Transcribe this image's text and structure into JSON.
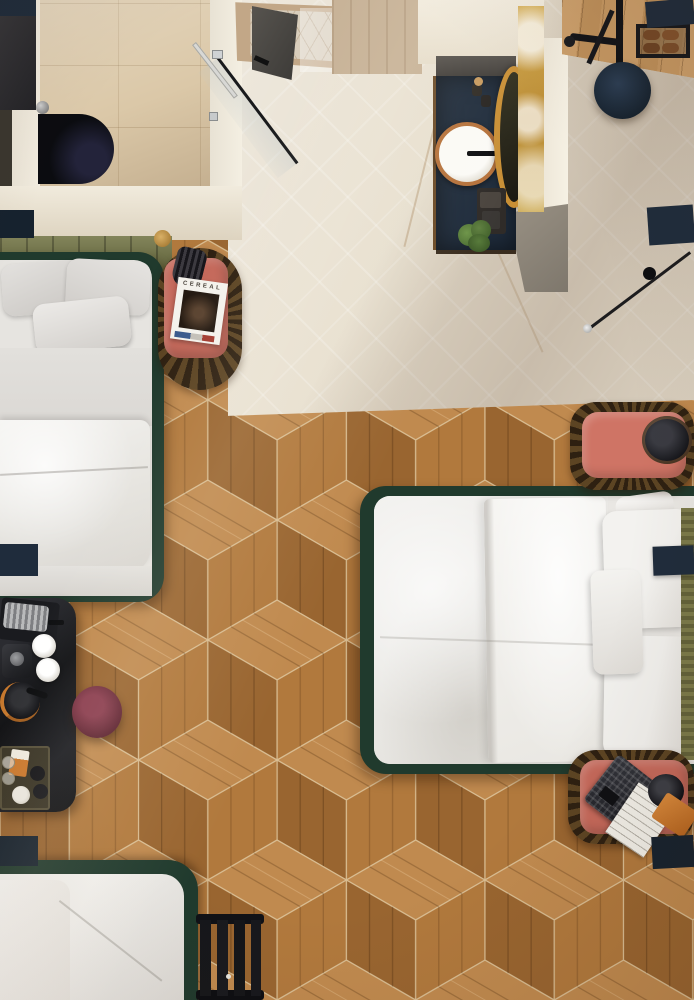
{
  "magazine": {
    "title": "CEREAL"
  },
  "palette": {
    "navy": "#1f2c3c",
    "navy_deep": "#16222e",
    "coral": "#c4685a",
    "coral_light": "#cf7465",
    "burgundy": "#5f2331",
    "olive": "#6d6f3e",
    "olive_throw": "#7b7a4a",
    "bed_frame_green": "#203a2d",
    "bed_frame_dark": "#152820",
    "wood_top": "#c08a4f",
    "wood_left": "#996530",
    "wood_right": "#b1793d",
    "wood_seam": "#d9bd92",
    "entry_wood": "#c2955f",
    "marble": "#e7dfcf",
    "bath_tile": "#dbc8a8",
    "wall": "#efe9dc",
    "wall_shade": "#90897d",
    "gold_marble": "#c89b3f",
    "copper": "#b5713a",
    "brass": "#b98a3c",
    "black": "#101116",
    "charcoal": "#2a2a2e",
    "chrome": "#d6d6d2",
    "white_bedding": "#f2f1ee",
    "gray_bedding": "#d8d5d1",
    "rattan": "#5c4423",
    "rattan_dark": "#2e2011",
    "plant_green": "#527436",
    "shoe_brown": "#744827",
    "orange_box": "#cd7a2e",
    "tan_panel": "#c7b297",
    "shower_frame": "#c2a787"
  },
  "furniture": [
    "single-bed",
    "double-bed",
    "sofa-bed",
    "nightstand-coral",
    "bedside-bench-coral",
    "rattan-mat",
    "magazine-cereal",
    "table-lamp",
    "floor-lamp",
    "desk-black",
    "coffee-machine",
    "espresso-cups",
    "kettle",
    "amenity-tray",
    "stool-burgundy",
    "luggage-rack",
    "vanity-navy",
    "round-sink",
    "gold-mirror",
    "gold-marble-strip",
    "plant",
    "shower-glass-door",
    "shower-tray",
    "towel-hooks",
    "black-bathtub",
    "coat-rack",
    "shoe-shelf",
    "ottoman-navy",
    "laptop",
    "headphones",
    "notebook-orange"
  ]
}
